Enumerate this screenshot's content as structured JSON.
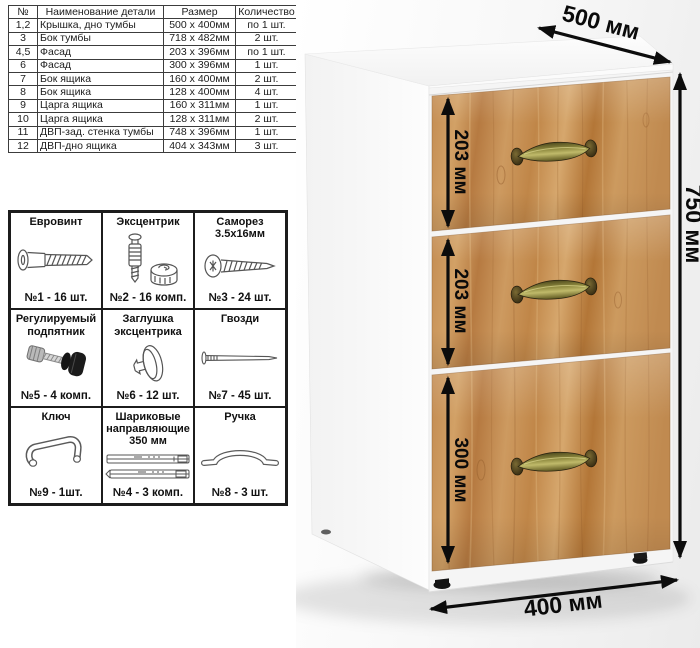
{
  "parts_table": {
    "headers": {
      "num": "№",
      "name": "Наименование детали",
      "size": "Размер",
      "qty": "Количество"
    },
    "rows": [
      {
        "num": "1,2",
        "name": "Крышка, дно тумбы",
        "size": "500 x 400мм",
        "qty": "по 1 шт."
      },
      {
        "num": "3",
        "name": "Бок тумбы",
        "size": "718 x 482мм",
        "qty": "2 шт."
      },
      {
        "num": "4,5",
        "name": "Фасад",
        "size": "203 x 396мм",
        "qty": "по 1 шт."
      },
      {
        "num": "6",
        "name": "Фасад",
        "size": "300 x 396мм",
        "qty": "1 шт."
      },
      {
        "num": "7",
        "name": "Бок ящика",
        "size": "160 x 400мм",
        "qty": "2 шт."
      },
      {
        "num": "8",
        "name": "Бок ящика",
        "size": "128 x 400мм",
        "qty": "4 шт."
      },
      {
        "num": "9",
        "name": "Царга ящика",
        "size": "160 x 311мм",
        "qty": "1 шт."
      },
      {
        "num": "10",
        "name": "Царга ящика",
        "size": "128 x 311мм",
        "qty": "2 шт."
      },
      {
        "num": "11",
        "name": "ДВП-зад. стенка тумбы",
        "size": "748 x 396мм",
        "qty": "1 шт."
      },
      {
        "num": "12",
        "name": "ДВП-дно ящика",
        "size": "404 x 343мм",
        "qty": "3 шт."
      }
    ]
  },
  "hardware": {
    "cells": [
      {
        "title": "Евровинт",
        "count": "№1 - 16 шт.",
        "icon": "euro-screw-icon"
      },
      {
        "title": "Эксцентрик",
        "count": "№2 - 16 комп.",
        "icon": "cam-lock-icon"
      },
      {
        "title": "Саморез 3.5x16мм",
        "count": "№3 - 24 шт.",
        "icon": "self-tapping-screw-icon"
      },
      {
        "title": "Регулируемый подпятник",
        "count": "№5 - 4 комп.",
        "icon": "adjustable-foot-icon"
      },
      {
        "title": "Заглушка эксцентрика",
        "count": "№6 - 12 шт.",
        "icon": "cam-cover-icon"
      },
      {
        "title": "Гвозди",
        "count": "№7 - 45 шт.",
        "icon": "nail-icon"
      },
      {
        "title": "Ключ",
        "count": "№9 - 1шт.",
        "icon": "hex-key-icon"
      },
      {
        "title": "Шариковые направляющие 350 мм",
        "count": "№4 - 3 комп.",
        "icon": "ball-slides-icon"
      },
      {
        "title": "Ручка",
        "count": "№8 - 3 шт.",
        "icon": "bow-handle-icon"
      }
    ]
  },
  "dimensions": {
    "depth": "500 мм",
    "height": "750 мм",
    "width": "400 мм",
    "drawer_top": "203 мм",
    "drawer_middle": "203 мм",
    "drawer_bottom": "300 мм"
  },
  "colors": {
    "wood": "#c28a50",
    "wood_dark": "#a06a38",
    "wood_light": "#d8a96e",
    "handle_brass": "#8f8a3f",
    "arrow": "#0c0c0c",
    "cabinet_body": "#fbfbfb"
  }
}
